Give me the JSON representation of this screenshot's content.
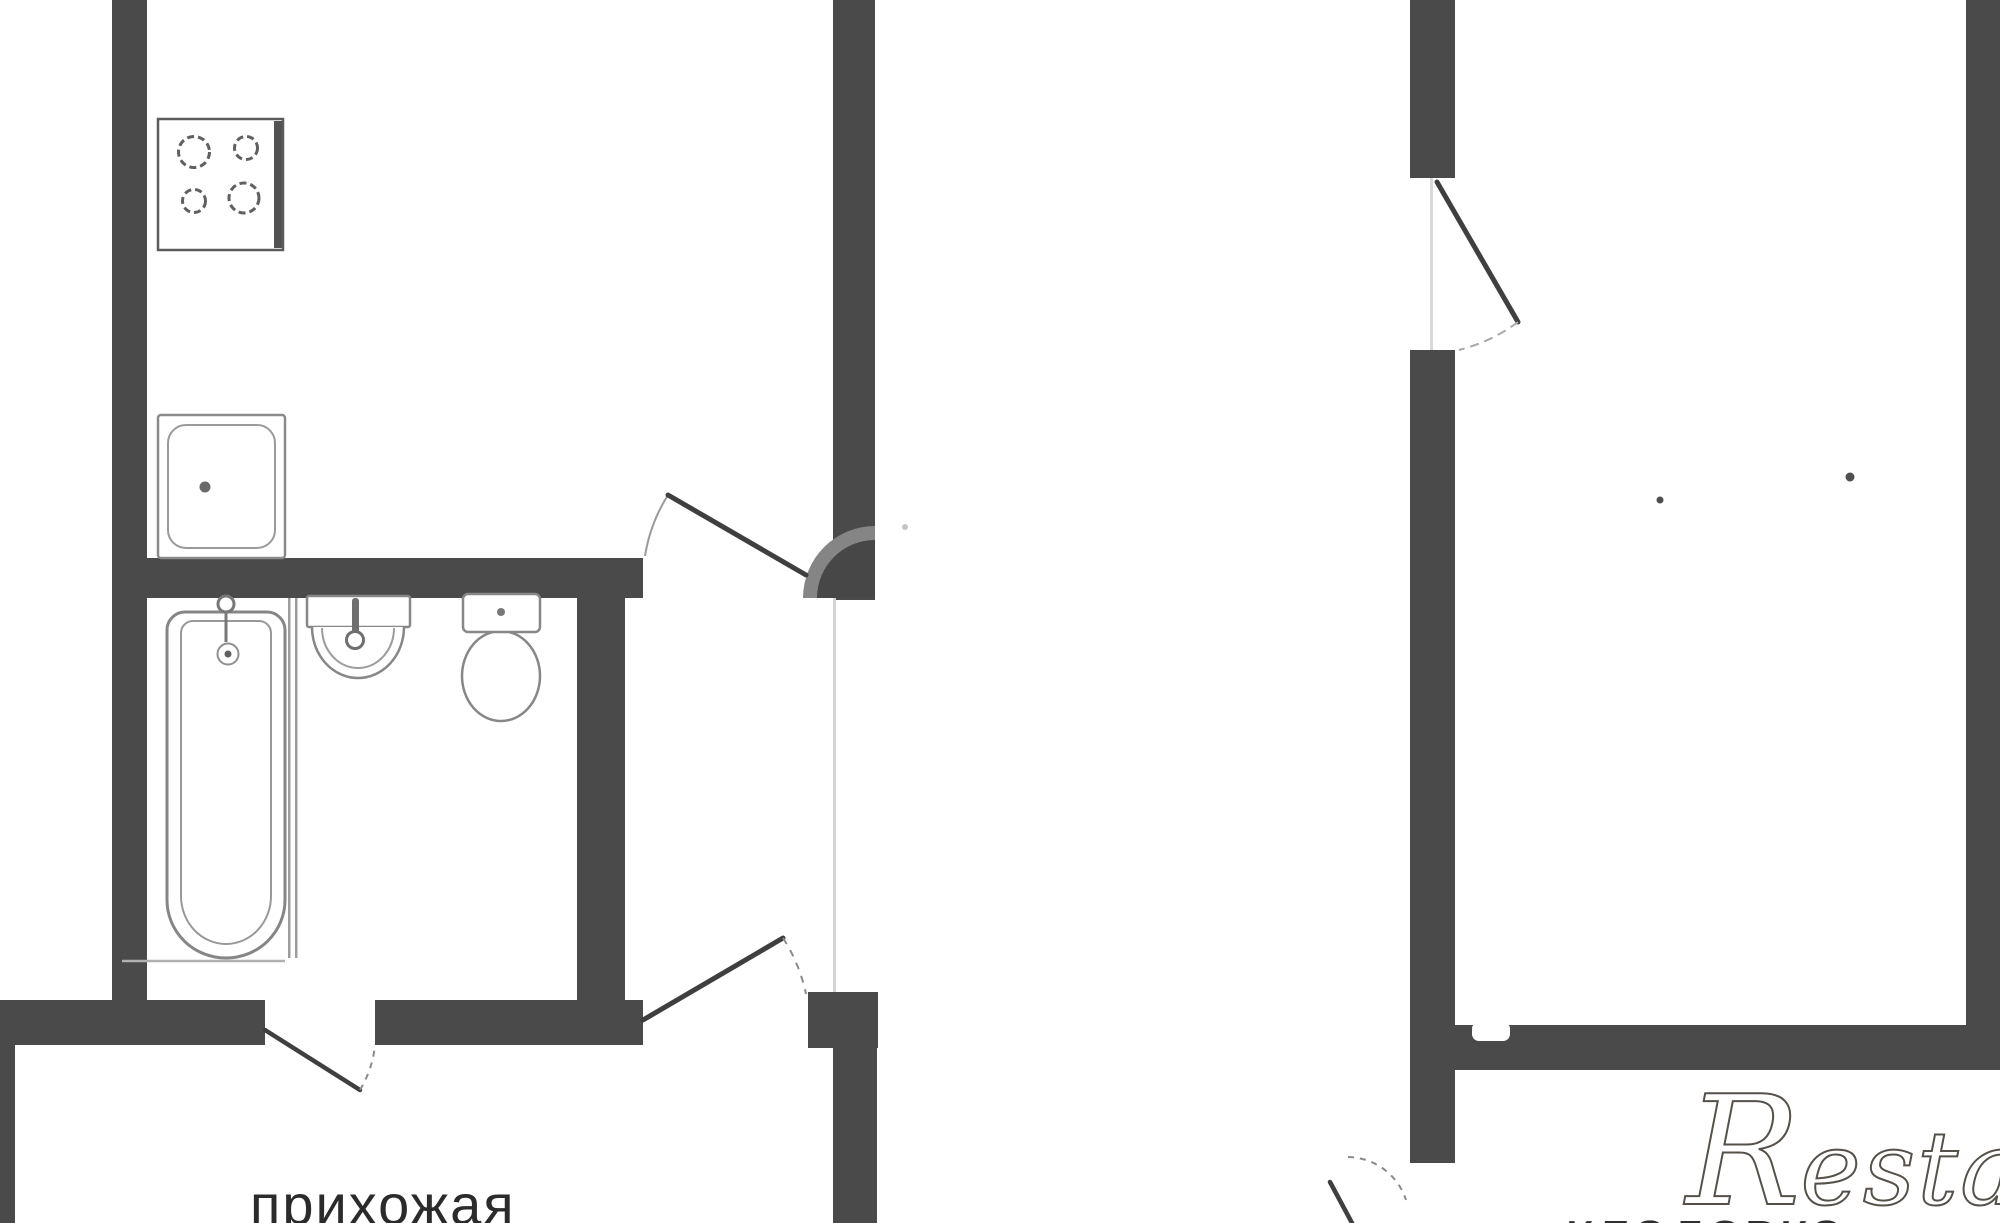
{
  "canvas": {
    "width": 2000,
    "height": 1223,
    "background": "#ffffff"
  },
  "palette": {
    "wall": "#4a4a4a",
    "fixture_stroke": "#878787",
    "door_leaf": "#3f3f3f",
    "arc": "#8a8a8a",
    "faint": "#d4d4d4",
    "label_text": "#2b2b2b",
    "watermark_gray": "#55504a"
  },
  "labels": {
    "hallway": "прихожая",
    "storage": "кладовка",
    "watermark_first": "R",
    "watermark_mid": "estat",
    "watermark_last": "e"
  },
  "svg": {
    "width": 2000,
    "height": 1223,
    "elements": [
      {
        "n": "left-outer-wall",
        "k": "rect",
        "a": {
          "x": 112,
          "y": 0,
          "width": 35,
          "height": 1045,
          "fill": "#4a4a4a"
        }
      },
      {
        "n": "kitchen-bottom-wall",
        "k": "rect",
        "a": {
          "x": 140,
          "y": 558,
          "width": 503,
          "height": 40,
          "fill": "#4a4a4a"
        }
      },
      {
        "n": "kitchen-right-wall",
        "k": "rect",
        "a": {
          "x": 833,
          "y": 0,
          "width": 42,
          "height": 600,
          "fill": "#4a4a4a"
        }
      },
      {
        "n": "bathroom-right-wall",
        "k": "rect",
        "a": {
          "x": 577,
          "y": 590,
          "width": 48,
          "height": 455,
          "fill": "#4a4a4a"
        }
      },
      {
        "n": "bottom-wall-left-segment",
        "k": "rect",
        "a": {
          "x": 0,
          "y": 1000,
          "width": 265,
          "height": 45,
          "fill": "#4a4a4a"
        }
      },
      {
        "n": "bottom-wall-mid-segment",
        "k": "rect",
        "a": {
          "x": 375,
          "y": 1000,
          "width": 268,
          "height": 45,
          "fill": "#4a4a4a"
        }
      },
      {
        "n": "entry-door-jamb-block",
        "k": "rect",
        "a": {
          "x": 808,
          "y": 992,
          "width": 70,
          "height": 56,
          "fill": "#4a4a4a"
        }
      },
      {
        "n": "corridor-lower-wall",
        "k": "rect",
        "a": {
          "x": 833,
          "y": 1045,
          "width": 44,
          "height": 178,
          "fill": "#4a4a4a"
        }
      },
      {
        "n": "left-edge-wall-sliver",
        "k": "rect",
        "a": {
          "x": 0,
          "y": 1045,
          "width": 15,
          "height": 178,
          "fill": "#4a4a4a"
        }
      },
      {
        "n": "right-unit-left-wall-upper",
        "k": "rect",
        "a": {
          "x": 1410,
          "y": 0,
          "width": 45,
          "height": 178,
          "fill": "#4a4a4a"
        }
      },
      {
        "n": "right-unit-left-wall-main",
        "k": "rect",
        "a": {
          "x": 1410,
          "y": 350,
          "width": 45,
          "height": 813,
          "fill": "#4a4a4a"
        }
      },
      {
        "n": "storage-top-wall",
        "k": "rect",
        "a": {
          "x": 1455,
          "y": 1025,
          "width": 511,
          "height": 45,
          "fill": "#4a4a4a"
        }
      },
      {
        "n": "right-outer-wall",
        "k": "rect",
        "a": {
          "x": 1966,
          "y": 0,
          "width": 34,
          "height": 1070,
          "fill": "#4a4a4a"
        }
      },
      {
        "n": "storage-wall-notch",
        "k": "rect",
        "a": {
          "x": 1472,
          "y": 1022,
          "width": 38,
          "height": 19,
          "rx": 7,
          "fill": "#ffffff"
        }
      },
      {
        "n": "corridor-open-edge-line",
        "k": "rect",
        "a": {
          "x": 833,
          "y": 598,
          "width": 3,
          "height": 394,
          "fill": "#d4d4d4"
        }
      },
      {
        "n": "right-door-gap-line",
        "k": "rect",
        "a": {
          "x": 1430,
          "y": 178,
          "width": 3,
          "height": 172,
          "fill": "#d9d9d9"
        }
      },
      {
        "n": "stove-outline",
        "k": "rect",
        "a": {
          "x": 158,
          "y": 119,
          "width": 125,
          "height": 131,
          "fill": "#ffffff",
          "stroke": "#5c5c5c",
          "stroke-width": 2.5
        }
      },
      {
        "n": "stove-right-rim",
        "k": "rect",
        "a": {
          "x": 274,
          "y": 121,
          "width": 8,
          "height": 127,
          "fill": "#525252"
        }
      },
      {
        "n": "stove-burner-top-left",
        "k": "circle",
        "a": {
          "cx": 194,
          "cy": 152,
          "r": 15.5,
          "fill": "none",
          "stroke": "#606060",
          "stroke-width": 3,
          "stroke-dasharray": "7,4"
        }
      },
      {
        "n": "stove-burner-top-right",
        "k": "circle",
        "a": {
          "cx": 246,
          "cy": 148,
          "r": 11.5,
          "fill": "none",
          "stroke": "#606060",
          "stroke-width": 3,
          "stroke-dasharray": "7,4"
        }
      },
      {
        "n": "stove-burner-bottom-left",
        "k": "circle",
        "a": {
          "cx": 194,
          "cy": 201,
          "r": 11.5,
          "fill": "none",
          "stroke": "#606060",
          "stroke-width": 3,
          "stroke-dasharray": "7,4"
        }
      },
      {
        "n": "stove-burner-bottom-right",
        "k": "circle",
        "a": {
          "cx": 244,
          "cy": 198,
          "r": 15,
          "fill": "none",
          "stroke": "#606060",
          "stroke-width": 3,
          "stroke-dasharray": "7,4"
        }
      },
      {
        "n": "kitchen-sink-outline",
        "k": "rect",
        "a": {
          "x": 158,
          "y": 415,
          "width": 127,
          "height": 143,
          "rx": 3,
          "fill": "#ffffff",
          "stroke": "#8a8a8a",
          "stroke-width": 2.5
        }
      },
      {
        "n": "kitchen-sink-inner",
        "k": "rect",
        "a": {
          "x": 168,
          "y": 425,
          "width": 107,
          "height": 123,
          "rx": 18,
          "fill": "none",
          "stroke": "#9a9a9a",
          "stroke-width": 2
        }
      },
      {
        "n": "kitchen-sink-drain",
        "k": "circle",
        "a": {
          "cx": 205,
          "cy": 487,
          "r": 5.5,
          "fill": "#6a6a6a"
        }
      },
      {
        "n": "bathtub-outline",
        "k": "path",
        "a": {
          "d": "M185,612 L267,612 A18,18 0 0 1 285,630 L285,900 A59,58 0 0 1 226,958 A59,58 0 0 1 167,900 L167,630 A18,18 0 0 1 185,612 Z",
          "fill": "#ffffff",
          "stroke": "#868686",
          "stroke-width": 3
        }
      },
      {
        "n": "bathtub-inner",
        "k": "path",
        "a": {
          "d": "M193,621 L259,621 A12,12 0 0 1 271,633 L271,896 A45,48 0 0 1 226,944 A45,48 0 0 1 181,896 L181,633 A12,12 0 0 1 193,621 Z",
          "fill": "none",
          "stroke": "#989898",
          "stroke-width": 2
        }
      },
      {
        "n": "bathtub-end-line",
        "k": "line",
        "a": {
          "x1": 122,
          "y1": 961,
          "x2": 285,
          "y2": 961,
          "stroke": "#b0b0b0",
          "stroke-width": 2.5
        }
      },
      {
        "n": "bathtub-tap-head",
        "k": "circle",
        "a": {
          "cx": 226,
          "cy": 604,
          "r": 8,
          "fill": "#ffffff",
          "stroke": "#787878",
          "stroke-width": 3
        }
      },
      {
        "n": "bathtub-tap-stem",
        "k": "line",
        "a": {
          "x1": 226,
          "y1": 612,
          "x2": 226,
          "y2": 642,
          "stroke": "#787878",
          "stroke-width": 3
        }
      },
      {
        "n": "bathtub-drain-ring",
        "k": "circle",
        "a": {
          "cx": 228,
          "cy": 654,
          "r": 10.5,
          "fill": "#ffffff",
          "stroke": "#909090",
          "stroke-width": 2
        }
      },
      {
        "n": "bathtub-drain-dot",
        "k": "circle",
        "a": {
          "cx": 228,
          "cy": 654,
          "r": 3.5,
          "fill": "#5f5f5f"
        }
      },
      {
        "n": "bath-partition-line-1",
        "k": "rect",
        "a": {
          "x": 288,
          "y": 598,
          "width": 2.5,
          "height": 360,
          "fill": "#9c9c9c"
        }
      },
      {
        "n": "bath-partition-line-2",
        "k": "rect",
        "a": {
          "x": 295,
          "y": 598,
          "width": 2.5,
          "height": 360,
          "fill": "#9c9c9c"
        }
      },
      {
        "n": "washbasin-top",
        "k": "rect",
        "a": {
          "x": 307,
          "y": 596,
          "width": 103,
          "height": 31,
          "rx": 2,
          "fill": "#ffffff",
          "stroke": "#878787",
          "stroke-width": 2.5
        }
      },
      {
        "n": "washbasin-bowl",
        "k": "path",
        "a": {
          "d": "M312,627 A46,51 0 1 0 404,627",
          "fill": "#ffffff",
          "stroke": "#878787",
          "stroke-width": 2.5
        }
      },
      {
        "n": "washbasin-bowl-inner",
        "k": "path",
        "a": {
          "d": "M322,628 A36,40 0 1 0 394,628",
          "fill": "none",
          "stroke": "#9c9c9c",
          "stroke-width": 2
        }
      },
      {
        "n": "washbasin-tap-stem",
        "k": "rect",
        "a": {
          "x": 352,
          "y": 598,
          "width": 7,
          "height": 38,
          "rx": 3,
          "fill": "#6f6f6f"
        }
      },
      {
        "n": "washbasin-tap-head",
        "k": "circle",
        "a": {
          "cx": 355,
          "cy": 640,
          "r": 8.5,
          "fill": "#ffffff",
          "stroke": "#6f6f6f",
          "stroke-width": 3
        }
      },
      {
        "n": "toilet-bowl",
        "k": "ellipse",
        "a": {
          "cx": 501,
          "cy": 676,
          "rx": 39,
          "ry": 45,
          "fill": "#ffffff",
          "stroke": "#878787",
          "stroke-width": 2.5
        }
      },
      {
        "n": "toilet-tank",
        "k": "rect",
        "a": {
          "x": 463,
          "y": 594,
          "width": 77,
          "height": 38,
          "rx": 5,
          "fill": "#ffffff",
          "stroke": "#878787",
          "stroke-width": 2.5
        }
      },
      {
        "n": "toilet-flush-button",
        "k": "circle",
        "a": {
          "cx": 501,
          "cy": 612,
          "r": 4,
          "fill": "#787878"
        }
      },
      {
        "n": "kitchen-door-hinge-ring",
        "k": "path",
        "a": {
          "d": "M875,598 L803,598 A72,72 0 0 1 875,526 Z",
          "fill": "#858585"
        }
      },
      {
        "n": "kitchen-door-hinge-disc",
        "k": "path",
        "a": {
          "d": "M875,598 L817,598 A58,58 0 0 1 875,540 Z",
          "fill": "#474747"
        }
      },
      {
        "n": "kitchen-door-arc",
        "k": "path",
        "a": {
          "d": "M668,495 A162,162 0 0 0 645,556",
          "fill": "none",
          "stroke": "#9a9a9a",
          "stroke-width": 2
        }
      },
      {
        "n": "kitchen-door-leaf",
        "k": "line",
        "a": {
          "x1": 806,
          "y1": 575,
          "x2": 668,
          "y2": 495,
          "stroke": "#3f3f3f",
          "stroke-width": 5,
          "stroke-linecap": "round"
        }
      },
      {
        "n": "entry-door-leaf",
        "k": "line",
        "a": {
          "x1": 643,
          "y1": 1020,
          "x2": 783,
          "y2": 938,
          "stroke": "#3f3f3f",
          "stroke-width": 5,
          "stroke-linecap": "round"
        }
      },
      {
        "n": "entry-door-arc",
        "k": "path",
        "a": {
          "d": "M783,938 A167,167 0 0 1 806,994",
          "fill": "none",
          "stroke": "#8a8a8a",
          "stroke-width": 2,
          "stroke-dasharray": "7,7"
        }
      },
      {
        "n": "bathroom-door-leaf",
        "k": "line",
        "a": {
          "x1": 265,
          "y1": 1030,
          "x2": 360,
          "y2": 1090,
          "stroke": "#3f3f3f",
          "stroke-width": 4.5,
          "stroke-linecap": "round"
        }
      },
      {
        "n": "bathroom-door-arc",
        "k": "path",
        "a": {
          "d": "M360,1090 A108,108 0 0 0 375,1045",
          "fill": "none",
          "stroke": "#8a8a8a",
          "stroke-width": 2,
          "stroke-dasharray": "6,6"
        }
      },
      {
        "n": "right-room-door-leaf",
        "k": "line",
        "a": {
          "x1": 1437,
          "y1": 182,
          "x2": 1518,
          "y2": 322,
          "stroke": "#3f3f3f",
          "stroke-width": 5,
          "stroke-linecap": "round"
        }
      },
      {
        "n": "right-room-door-arc",
        "k": "path",
        "a": {
          "d": "M1518,322 A166,166 0 0 1 1459,350",
          "fill": "none",
          "stroke": "#a8a8a8",
          "stroke-width": 2,
          "stroke-dasharray": "9,6"
        }
      },
      {
        "n": "storage-door-leaf",
        "k": "line",
        "a": {
          "x1": 1330,
          "y1": 1182,
          "x2": 1352,
          "y2": 1223,
          "stroke": "#3f3f3f",
          "stroke-width": 4.5,
          "stroke-linecap": "round"
        }
      },
      {
        "n": "storage-door-arc",
        "k": "path",
        "a": {
          "d": "M1348,1157 A62,62 0 0 1 1406,1200",
          "fill": "none",
          "stroke": "#8a8a8a",
          "stroke-width": 2,
          "stroke-dasharray": "6,6"
        }
      },
      {
        "n": "right-room-dot-1",
        "k": "circle",
        "a": {
          "cx": 1660,
          "cy": 500,
          "r": 3.5,
          "fill": "#4f4f4f"
        }
      },
      {
        "n": "right-room-dot-2",
        "k": "circle",
        "a": {
          "cx": 1850,
          "cy": 477,
          "r": 4.5,
          "fill": "#4f4f4f"
        }
      },
      {
        "n": "hall-faint-dot",
        "k": "circle",
        "a": {
          "cx": 905,
          "cy": 527,
          "r": 3,
          "fill": "#c4c4c4"
        }
      }
    ]
  }
}
